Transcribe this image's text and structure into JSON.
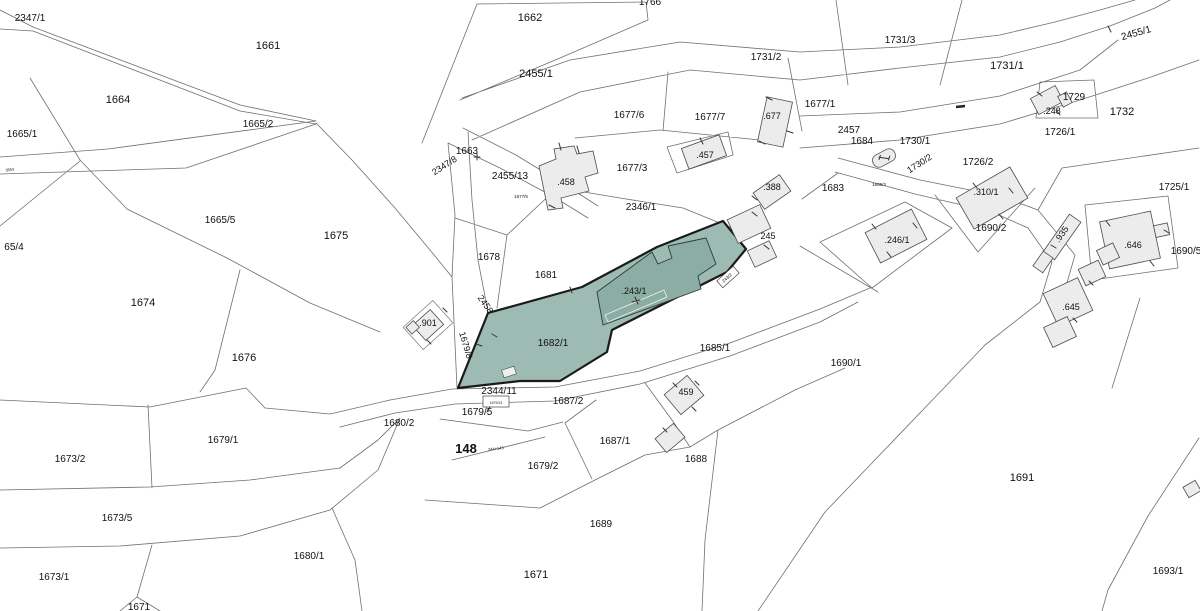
{
  "map": {
    "type": "cadastral-parcel-map",
    "highlighted_parcels": [
      "1682/1",
      "243/1"
    ],
    "colors": {
      "background": "#ffffff",
      "boundary": "#6f6f6f",
      "highlight_fill": "#9dbbb3",
      "highlight_building_fill": "#8cada3",
      "highlight_outline": "#1a1a1a",
      "building_fill": "#ececec",
      "building_outline": "#4d4d4d",
      "label_color": "#111111"
    },
    "labels": [
      {
        "t": "2347/1",
        "x": 30,
        "y": 21,
        "s": 10
      },
      {
        "t": "1661",
        "x": 268,
        "y": 49,
        "s": 11
      },
      {
        "t": "1664",
        "x": 118,
        "y": 103,
        "s": 11
      },
      {
        "t": "1665/2",
        "x": 258,
        "y": 127,
        "s": 10
      },
      {
        "t": "1665/1",
        "x": 22,
        "y": 137,
        "s": 10
      },
      {
        "t": "3553",
        "x": 10,
        "y": 171,
        "s": 4,
        "r": -8
      },
      {
        "t": "65/4",
        "x": 14,
        "y": 250,
        "s": 10
      },
      {
        "t": "1665/5",
        "x": 220,
        "y": 223,
        "s": 10
      },
      {
        "t": "1675",
        "x": 336,
        "y": 239,
        "s": 11
      },
      {
        "t": "1674",
        "x": 143,
        "y": 306,
        "s": 11
      },
      {
        "t": "1676",
        "x": 244,
        "y": 361,
        "s": 11
      },
      {
        "t": "1673/2",
        "x": 70,
        "y": 462,
        "s": 10
      },
      {
        "t": "1679/1",
        "x": 223,
        "y": 443,
        "s": 10
      },
      {
        "t": "1673/5",
        "x": 117,
        "y": 521,
        "s": 10
      },
      {
        "t": "1673/1",
        "x": 54,
        "y": 580,
        "s": 10
      },
      {
        "t": "1680/1",
        "x": 309,
        "y": 559,
        "s": 10
      },
      {
        "t": "1671",
        "x": 139,
        "y": 610,
        "s": 10
      },
      {
        "t": "1766",
        "x": 650,
        "y": 5,
        "s": 10
      },
      {
        "t": "1662",
        "x": 530,
        "y": 21,
        "s": 11
      },
      {
        "t": "2455/1",
        "x": 536,
        "y": 77,
        "s": 11
      },
      {
        "t": "1663",
        "x": 467,
        "y": 154,
        "s": 10
      },
      {
        "t": "2347/8",
        "x": 446,
        "y": 168,
        "s": 9,
        "r": -33
      },
      {
        "t": "2455/13",
        "x": 510,
        "y": 179,
        "s": 10
      },
      {
        "t": ".458",
        "x": 566,
        "y": 185,
        "s": 9
      },
      {
        "t": "1677/6",
        "x": 629,
        "y": 118,
        "s": 10
      },
      {
        "t": "1677/7",
        "x": 710,
        "y": 120,
        "s": 10
      },
      {
        "t": ".677",
        "x": 772,
        "y": 119,
        "s": 9
      },
      {
        "t": "1677/3",
        "x": 632,
        "y": 171,
        "s": 10
      },
      {
        "t": ".457",
        "x": 705,
        "y": 158,
        "s": 9
      },
      {
        "t": "1677/5",
        "x": 521,
        "y": 198,
        "s": 4.5
      },
      {
        "t": "2346/1",
        "x": 641,
        "y": 210,
        "s": 10
      },
      {
        "t": "1677/1",
        "x": 820,
        "y": 107,
        "s": 10
      },
      {
        "t": "1731/2",
        "x": 766,
        "y": 60,
        "s": 10
      },
      {
        "t": "1731/3",
        "x": 900,
        "y": 43,
        "s": 10
      },
      {
        "t": "1731/1",
        "x": 1007,
        "y": 69,
        "s": 11
      },
      {
        "t": "2455/1",
        "x": 1137,
        "y": 36,
        "s": 10,
        "r": -16
      },
      {
        "t": "2457",
        "x": 849,
        "y": 133,
        "s": 10
      },
      {
        "t": "1684",
        "x": 862,
        "y": 144,
        "s": 10
      },
      {
        "t": ".248",
        "x": 1052,
        "y": 114,
        "s": 9
      },
      {
        "t": "1729",
        "x": 1074,
        "y": 100,
        "s": 10
      },
      {
        "t": "1732",
        "x": 1122,
        "y": 115,
        "s": 11
      },
      {
        "t": "1726/1",
        "x": 1060,
        "y": 135,
        "s": 10
      },
      {
        "t": "1730/1",
        "x": 915,
        "y": 144,
        "s": 10
      },
      {
        "t": "1730/2",
        "x": 921,
        "y": 166,
        "s": 9,
        "r": -33
      },
      {
        "t": "1726/2",
        "x": 978,
        "y": 165,
        "s": 10
      },
      {
        "t": "1725/1",
        "x": 1174,
        "y": 190,
        "s": 10
      },
      {
        "t": ".388",
        "x": 772,
        "y": 190,
        "s": 9
      },
      {
        "t": "1683",
        "x": 833,
        "y": 191,
        "s": 10
      },
      {
        "t": "1685/3",
        "x": 879,
        "y": 186,
        "s": 4.5
      },
      {
        "t": ".310/1",
        "x": 986,
        "y": 195,
        "s": 9
      },
      {
        "t": "1690/2",
        "x": 991,
        "y": 231,
        "s": 10
      },
      {
        "t": ".246/1",
        "x": 897,
        "y": 243,
        "s": 9
      },
      {
        "t": ".935",
        "x": 1064,
        "y": 236,
        "s": 9,
        "r": -55
      },
      {
        "t": ".646",
        "x": 1133,
        "y": 248,
        "s": 9
      },
      {
        "t": "1690/5",
        "x": 1186,
        "y": 254,
        "s": 10
      },
      {
        "t": ".645",
        "x": 1071,
        "y": 310,
        "s": 9
      },
      {
        "t": "1690/1",
        "x": 846,
        "y": 366,
        "s": 10
      },
      {
        "t": "1678",
        "x": 489,
        "y": 260,
        "s": 10
      },
      {
        "t": "1681",
        "x": 546,
        "y": 278,
        "s": 10
      },
      {
        "t": ".243/1",
        "x": 634,
        "y": 294,
        "s": 9
      },
      {
        "t": "243/2",
        "x": 728,
        "y": 279,
        "s": 4.5,
        "r": -42
      },
      {
        "t": "245",
        "x": 768,
        "y": 239,
        "s": 9
      },
      {
        "t": "1682/1",
        "x": 553,
        "y": 346,
        "s": 10
      },
      {
        "t": "1685/1",
        "x": 715,
        "y": 351,
        "s": 10
      },
      {
        "t": ".901",
        "x": 428,
        "y": 326,
        "s": 9
      },
      {
        "t": "2458",
        "x": 483,
        "y": 306,
        "s": 9,
        "r": 55
      },
      {
        "t": "1679/8",
        "x": 463,
        "y": 346,
        "s": 9,
        "r": 73
      },
      {
        "t": "2344/11",
        "x": 499,
        "y": 394,
        "s": 10
      },
      {
        "t": "1687/2",
        "x": 568,
        "y": 404,
        "s": 10
      },
      {
        "t": "1679/5",
        "x": 477,
        "y": 415,
        "s": 10
      },
      {
        "t": "1680/2",
        "x": 399,
        "y": 426,
        "s": 10
      },
      {
        "t": "148",
        "x": 466,
        "y": 453,
        "s": 13,
        "b": 1
      },
      {
        "t": "244+143",
        "x": 496,
        "y": 450,
        "s": 4,
        "r": -6
      },
      {
        "t": "1679/13",
        "x": 496,
        "y": 404,
        "s": 3.5
      },
      {
        "t": "1679/2",
        "x": 543,
        "y": 469,
        "s": 10
      },
      {
        "t": "1687/1",
        "x": 615,
        "y": 444,
        "s": 10
      },
      {
        "t": "1688",
        "x": 696,
        "y": 462,
        "s": 10
      },
      {
        "t": "459",
        "x": 686,
        "y": 395,
        "s": 9
      },
      {
        "t": "1689",
        "x": 601,
        "y": 527,
        "s": 10
      },
      {
        "t": "1671",
        "x": 536,
        "y": 578,
        "s": 11
      },
      {
        "t": "1691",
        "x": 1022,
        "y": 481,
        "s": 11
      },
      {
        "t": "1693/1",
        "x": 1168,
        "y": 574,
        "s": 10
      }
    ]
  }
}
